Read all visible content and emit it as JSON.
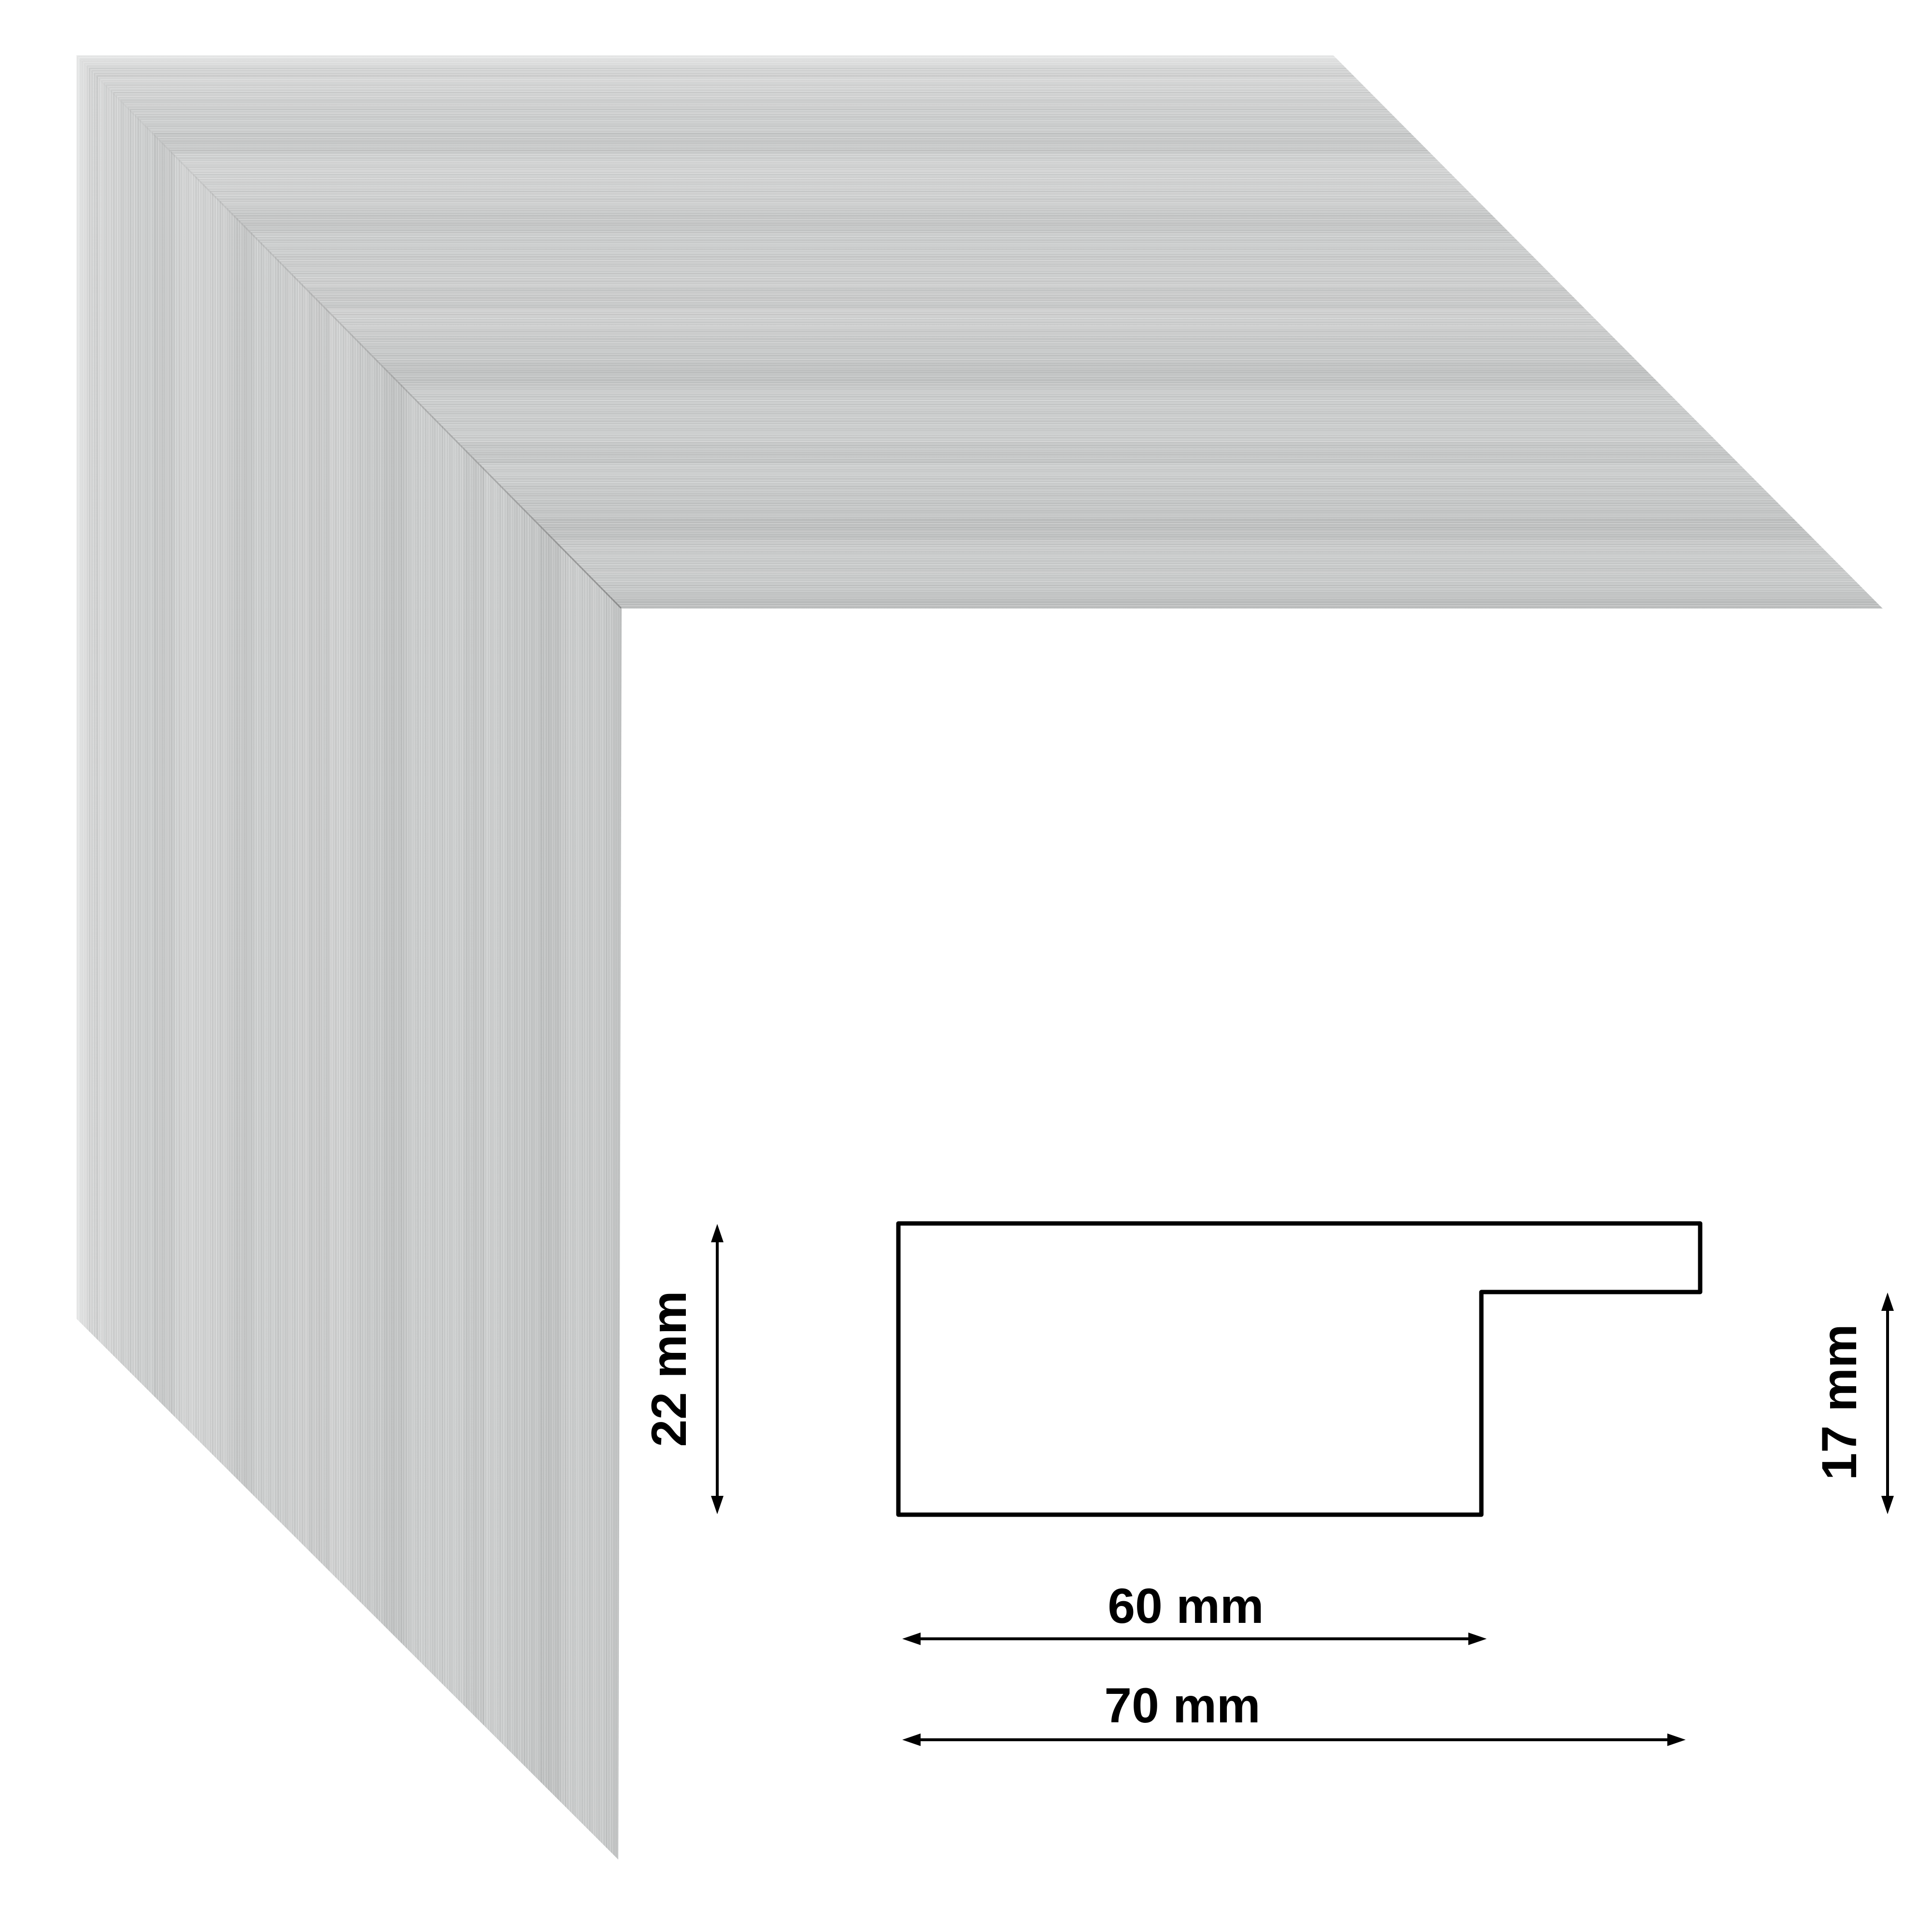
{
  "page": {
    "background_color": "#ffffff",
    "description": "Product sheet image: brushed silver picture-frame moulding corner sample with cross-section profile drawing and dimensions"
  },
  "frame_sample": {
    "finish": "brushed silver aluminum",
    "face_base_color": "#c7c9c9",
    "streak_highlight_color": "#e8e9e9",
    "streak_shadow_color": "#b5b7b7",
    "outer_edge_highlight_color": "#f0f1f1",
    "miter_seam_color": "#6a6a6a"
  },
  "profile_diagram": {
    "outline_color": "#000000",
    "fill_color": "#ffffff",
    "labels": {
      "height": "22 mm",
      "rabbet_height": "17 mm",
      "face_width": "60 mm",
      "overall_width": "70 mm"
    },
    "dimensions_mm": {
      "height": 22,
      "rabbet_height": 17,
      "face_width": 60,
      "overall_width": 70
    }
  }
}
